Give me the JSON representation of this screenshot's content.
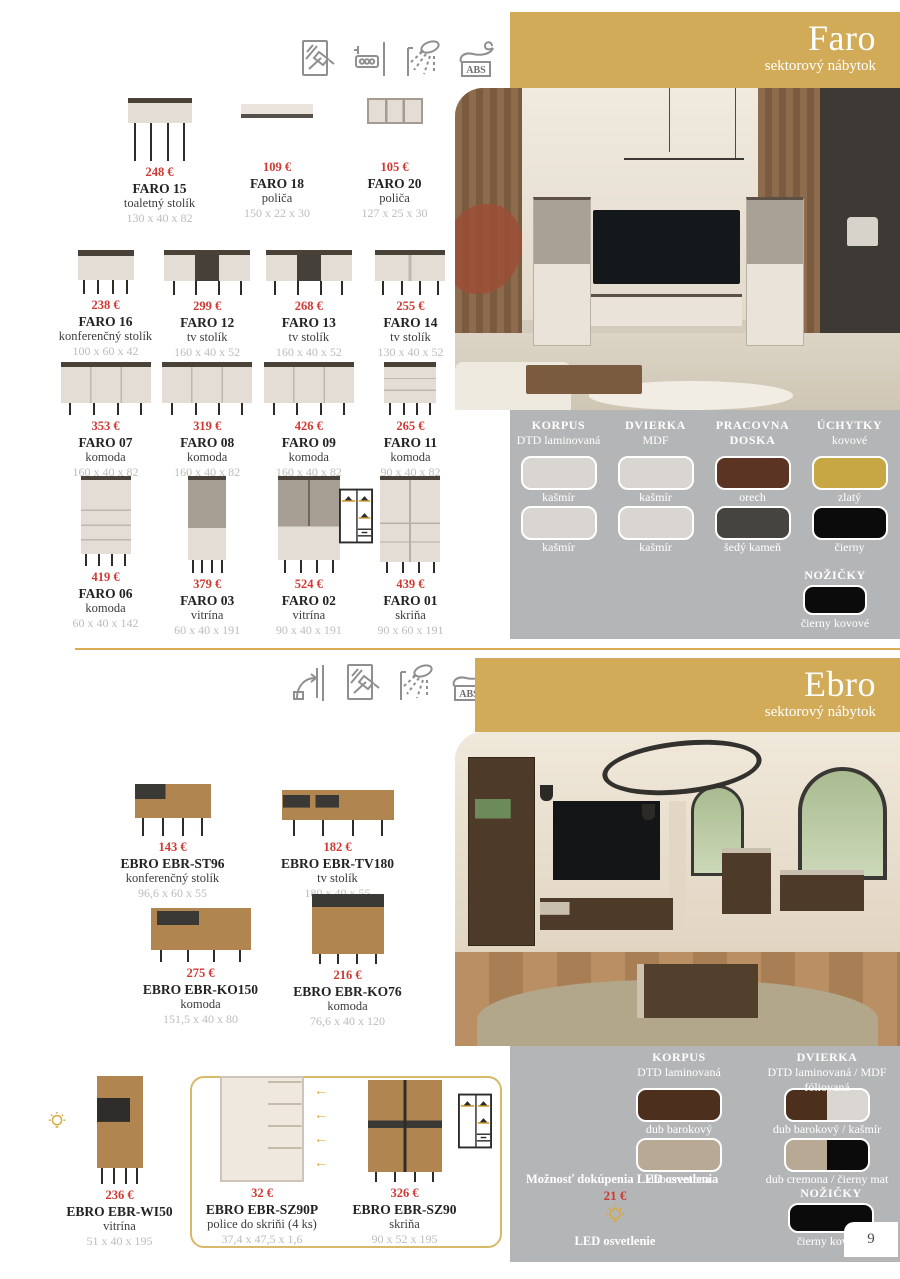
{
  "colors": {
    "banner_gold": "#d1ab58",
    "panel_gray": "#b4b5b6",
    "price_red": "#cf3933",
    "accent_gold": "#d9a93e",
    "divider_gold": "#ddab53"
  },
  "page": {
    "number": "9"
  },
  "sections": [
    {
      "title": "Faro",
      "subtitle": "sektorový nábytok",
      "feature_icons": [
        {
          "name": "tempered-glass-icon"
        },
        {
          "name": "wall-mount-icon"
        },
        {
          "name": "moisture-protection-icon"
        },
        {
          "name": "abs-edge-icon",
          "label": "ABS"
        }
      ],
      "rows": [
        [
          {
            "price": "248 €",
            "name": "FARO 15",
            "desc": "toaletný stolík",
            "dims": "130 x 40 x 82",
            "shape": "console"
          },
          {
            "price": "109 €",
            "name": "FARO 18",
            "desc": "poliča",
            "dims": "150 x 22 x 30",
            "shape": "shelf"
          },
          {
            "price": "105 €",
            "name": "FARO 20",
            "desc": "poliča",
            "dims": "127 x 25 x 30",
            "shape": "cubby"
          }
        ],
        [
          {
            "price": "238 €",
            "name": "FARO 16",
            "desc": "konferenčný stolík",
            "dims": "100 x 60 x 42",
            "shape": "coffee"
          },
          {
            "price": "299 €",
            "name": "FARO 12",
            "desc": "tv stolík",
            "dims": "160 x 40 x 52",
            "shape": "tv"
          },
          {
            "price": "268 €",
            "name": "FARO 13",
            "desc": "tv stolík",
            "dims": "160 x 40 x 52",
            "shape": "tv"
          },
          {
            "price": "255 €",
            "name": "FARO 14",
            "desc": "tv stolík",
            "dims": "130 x 40 x 52",
            "shape": "tv-sm"
          }
        ],
        [
          {
            "price": "353 €",
            "name": "FARO 07",
            "desc": "komoda",
            "dims": "160 x 40 x 82",
            "shape": "sideboard"
          },
          {
            "price": "319 €",
            "name": "FARO 08",
            "desc": "komoda",
            "dims": "160 x 40 x 82",
            "shape": "sideboard"
          },
          {
            "price": "426 €",
            "name": "FARO 09",
            "desc": "komoda",
            "dims": "160 x 40 x 82",
            "shape": "sideboard"
          },
          {
            "price": "265 €",
            "name": "FARO 11",
            "desc": "komoda",
            "dims": "90 x 40 x 82",
            "shape": "chest-sm"
          }
        ],
        [
          {
            "price": "419 €",
            "name": "FARO 06",
            "desc": "komoda",
            "dims": "60 x 40 x 142",
            "shape": "chest-tall"
          },
          {
            "price": "379 €",
            "name": "FARO 03",
            "desc": "vitrína",
            "dims": "60 x 40 x 191",
            "shape": "vitrine"
          },
          {
            "price": "524 €",
            "name": "FARO 02",
            "desc": "vitrína",
            "dims": "90 x 40 x 191",
            "shape": "vitrine-w"
          },
          {
            "price": "439 €",
            "name": "FARO 01",
            "desc": "skriňa",
            "dims": "90 x 60 x 191",
            "shape": "wardrobe",
            "extra": "ward-left"
          }
        ]
      ],
      "materials": {
        "columns": [
          {
            "title": "KORPUS",
            "subtitle": "DTD laminovaná",
            "swatches": [
              {
                "label": "kašmír",
                "colors": [
                  "#d9d5d1"
                ]
              },
              {
                "label": "kašmír",
                "colors": [
                  "#d9d5d1"
                ]
              }
            ]
          },
          {
            "title": "DVIERKA",
            "subtitle": "MDF",
            "swatches": [
              {
                "label": "kašmír",
                "colors": [
                  "#d9d5d1"
                ]
              },
              {
                "label": "kašmír",
                "colors": [
                  "#d9d5d1"
                ]
              }
            ]
          },
          {
            "title": "PRACOVNA DOSKA",
            "subtitle": "",
            "swatches": [
              {
                "label": "orech",
                "colors": [
                  "#5b3423"
                ]
              },
              {
                "label": "šedý kameň",
                "colors": [
                  "#45443f"
                ]
              }
            ]
          },
          {
            "title": "ÚCHYTKY",
            "subtitle": "kovové",
            "swatches": [
              {
                "label": "zlatý",
                "colors": [
                  "#c7a644"
                ]
              },
              {
                "label": "čierny",
                "colors": [
                  "#0b0b0b"
                ]
              }
            ]
          }
        ],
        "legs": {
          "title": "NOŽIČKY",
          "label": "čierny kovové",
          "color": "#0b0b0b"
        }
      }
    },
    {
      "title": "Ebro",
      "subtitle": "sektorový nábytok",
      "feature_icons": [
        {
          "name": "wall-fixing-icon"
        },
        {
          "name": "tempered-glass-icon"
        },
        {
          "name": "moisture-protection-icon"
        },
        {
          "name": "abs-edge-icon",
          "label": "ABS"
        }
      ],
      "rows": [
        [
          {
            "price": "143 €",
            "name": "EBRO EBR-ST96",
            "desc": "konferenčný stolík",
            "dims": "96,6 x 60 x 55",
            "shape": "coffee-e"
          },
          {
            "price": "182 €",
            "name": "EBRO EBR-TV180",
            "desc": "tv stolík",
            "dims": "180 x 40 x 55",
            "shape": "tv-e"
          }
        ],
        [
          {
            "price": "275 €",
            "name": "EBRO EBR-KO150",
            "desc": "komoda",
            "dims": "151,5 x 40 x 80",
            "shape": "sideboard-e"
          },
          {
            "price": "216 €",
            "name": "EBRO EBR-KO76",
            "desc": "komoda",
            "dims": "76,6 x 40 x 120",
            "shape": "highboard-e"
          }
        ],
        [
          {
            "price": "236 €",
            "name": "EBRO EBR-WI50",
            "desc": "vitrína",
            "dims": "51 x 40 x 195",
            "shape": "vitrine-e",
            "extra": "led"
          },
          {
            "price": "32 €",
            "name": "EBRO EBR-SZ90P",
            "desc": "police do skriňi (4 ks)",
            "dims": "37,4 x 47,5 x 1,6",
            "shape": "openwardrobe"
          },
          {
            "price": "326 €",
            "name": "EBRO EBR-SZ90",
            "desc": "skriňa",
            "dims": "90 x 52 x 195",
            "shape": "wardrobe-e",
            "extra": "ward-right"
          }
        ]
      ],
      "materials": {
        "columns": [
          {
            "title": "KORPUS",
            "subtitle": "DTD laminovaná",
            "swatches": [
              {
                "label": "dub barokový",
                "colors": [
                  "#4c301d"
                ]
              },
              {
                "label": "dub cremona",
                "colors": [
                  "#b7a994"
                ]
              }
            ]
          },
          {
            "title": "DVIERKA",
            "subtitle": "DTD laminovaná / MDF fóliovaná",
            "swatches": [
              {
                "label": "dub barokový / kašmír",
                "colors": [
                  "#4c301d",
                  "#dad6d2"
                ]
              },
              {
                "label": "dub cremona / čierny mat",
                "colors": [
                  "#b7a994",
                  "#0b0b0b"
                ]
              }
            ]
          }
        ],
        "legs": {
          "title": "NOŽIČKY",
          "label": "čierny kovové",
          "color": "#0b0b0b"
        },
        "led": {
          "note": "Možnosť dokúpenia LED osvetlenia",
          "price": "21 €",
          "label": "LED osvetlenie"
        }
      }
    }
  ]
}
